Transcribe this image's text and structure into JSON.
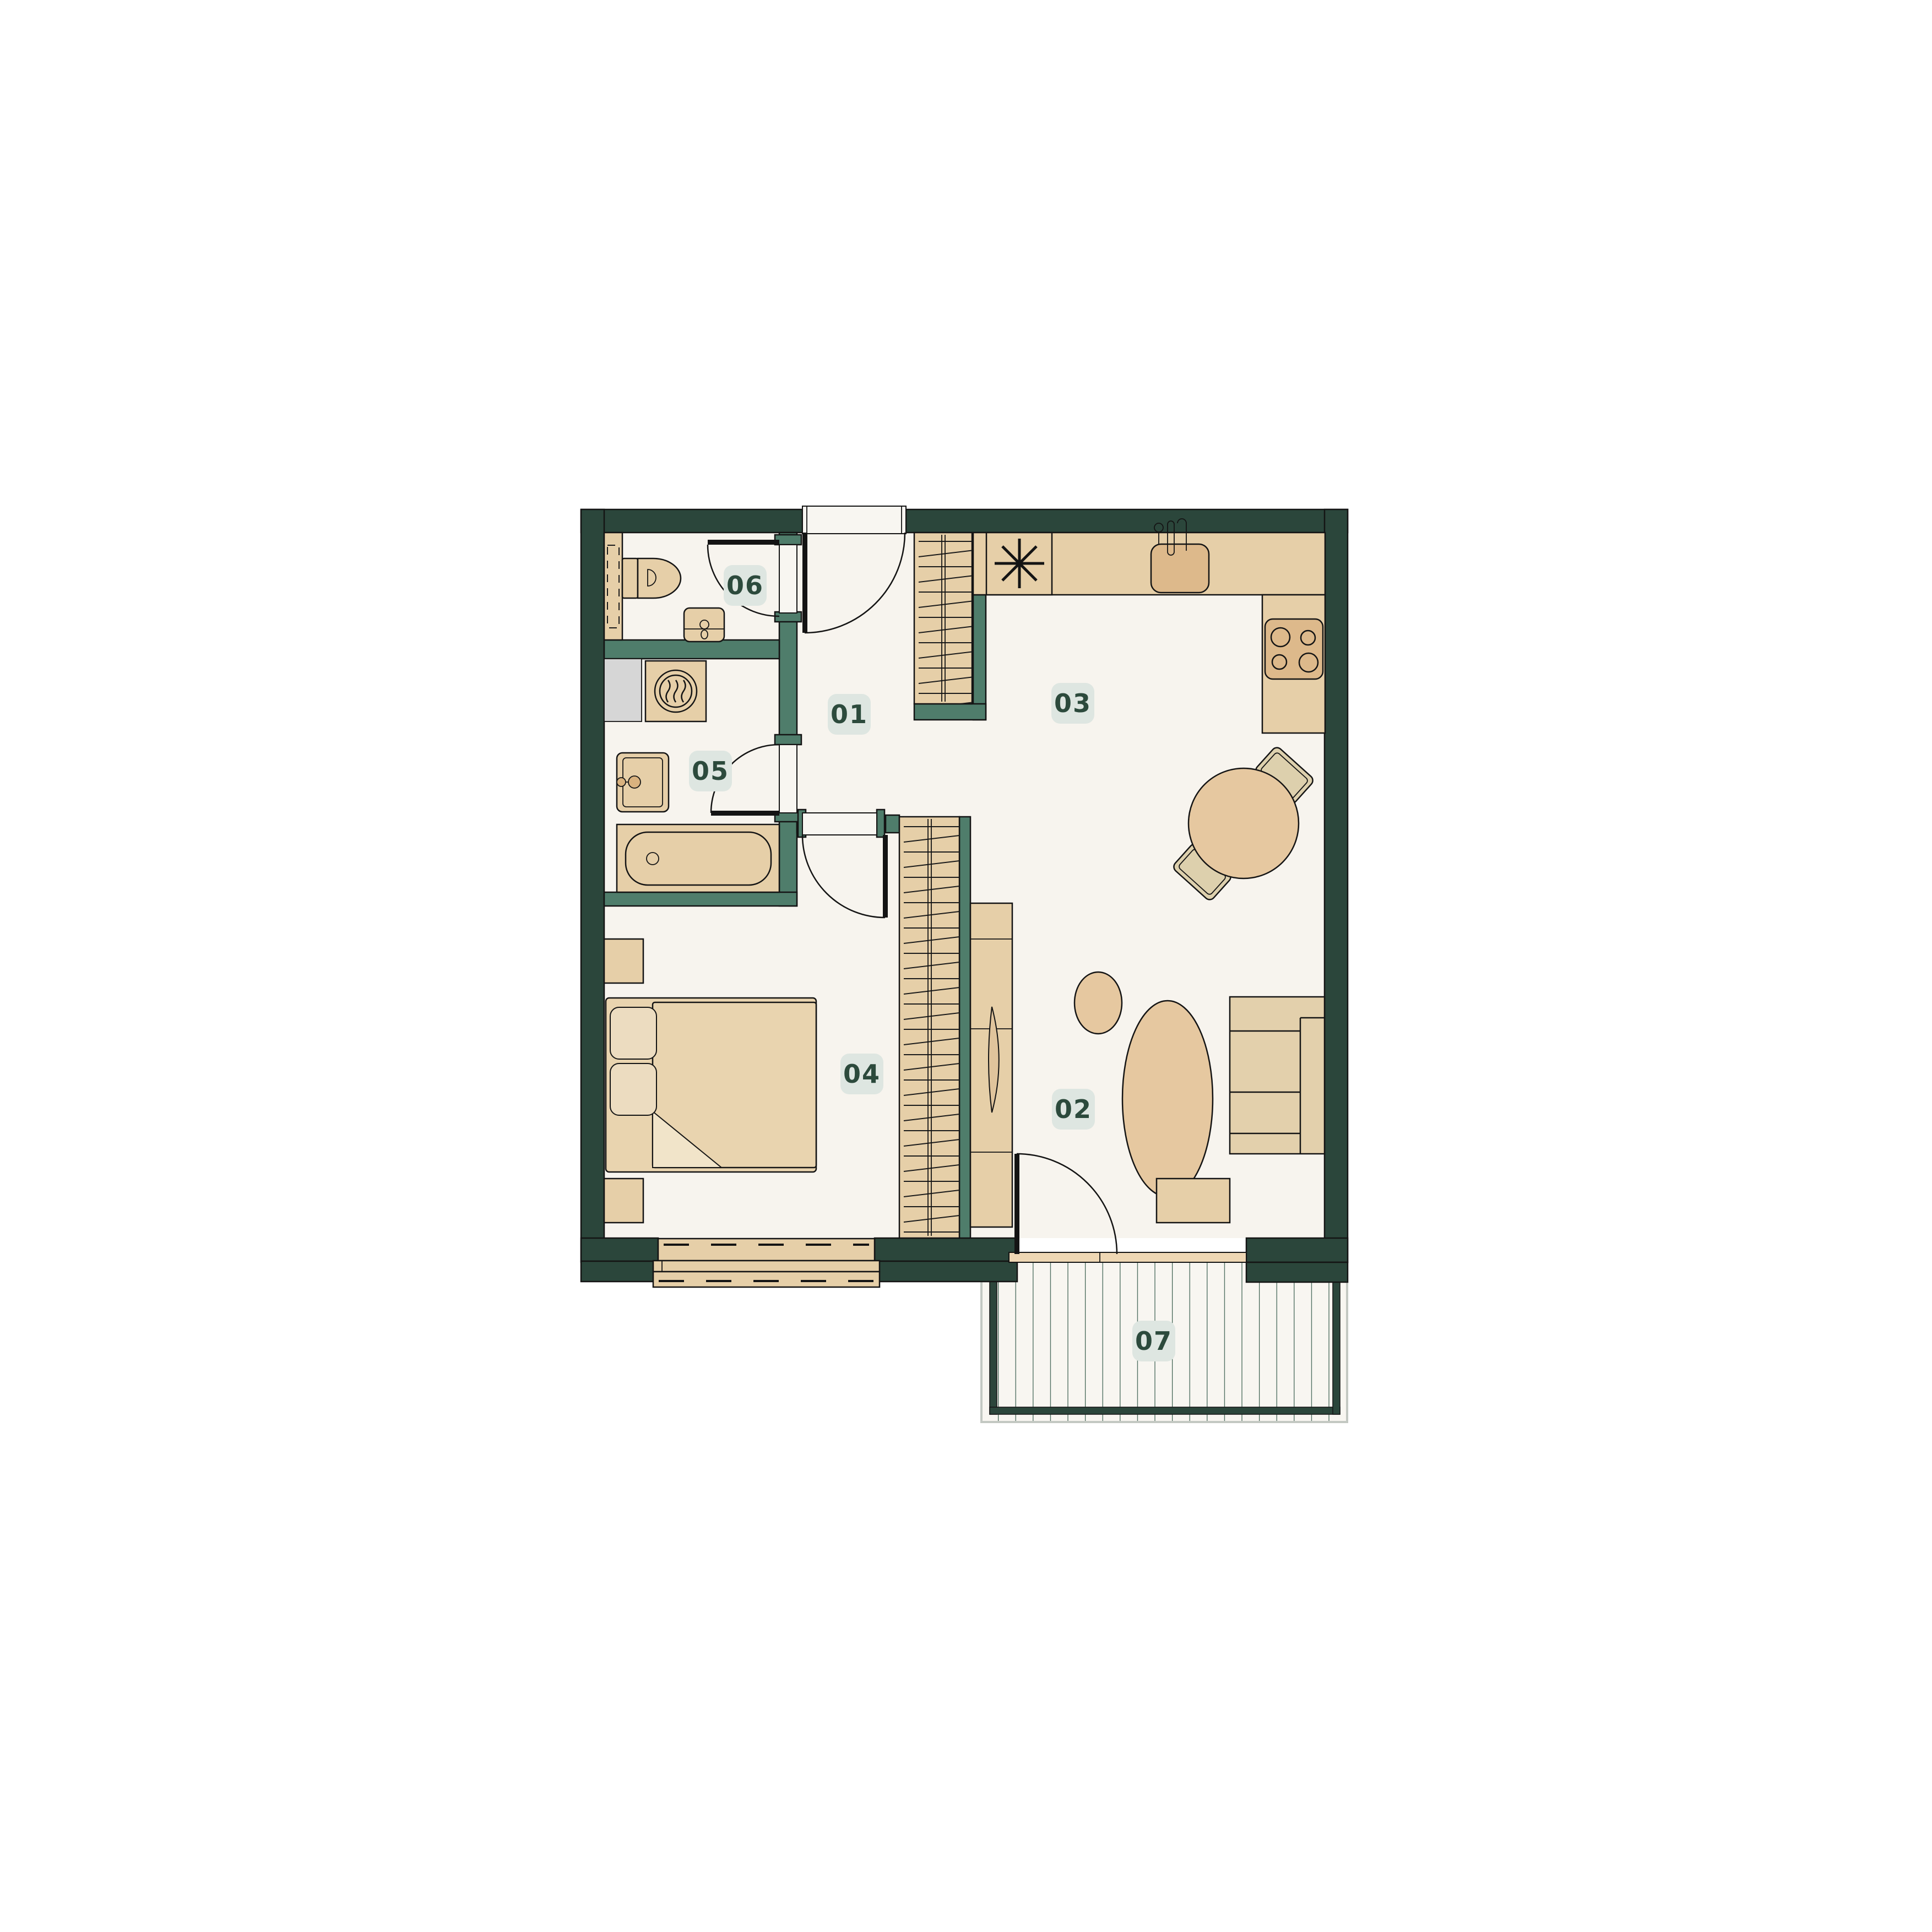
{
  "colors": {
    "background": "#ffffff",
    "wall_dark_green": "#2b463b",
    "partition_teal": "#4f7d6b",
    "floor": "#f7f4ee",
    "furniture_tan_light": "#e6cfa8",
    "furniture_tan_dark": "#ddb98b",
    "shaft_gray": "#d6d6d6",
    "label_background": "#dee6e1",
    "label_text": "#2c4a3c",
    "deck_line": "#3e6152"
  },
  "rooms": [
    {
      "label": "01"
    },
    {
      "label": "02"
    },
    {
      "label": "03"
    },
    {
      "label": "04"
    },
    {
      "label": "05"
    },
    {
      "label": "06"
    },
    {
      "label": "07"
    }
  ]
}
